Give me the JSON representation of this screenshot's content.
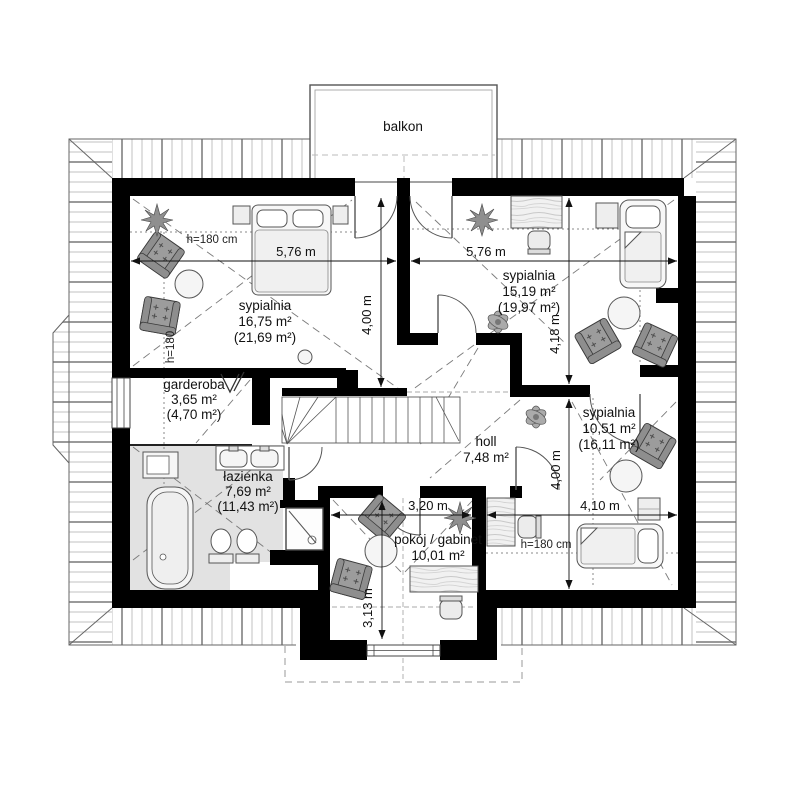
{
  "balcony": {
    "label": "balkon"
  },
  "rooms": {
    "sypialnia1": {
      "name": "sypialnia",
      "area": "16,75 m²",
      "area_roof": "(21,69 m²)"
    },
    "sypialnia2": {
      "name": "sypialnia",
      "area": "15,19 m²",
      "area_roof": "(19,97 m²)"
    },
    "garderoba": {
      "name": "garderoba",
      "area": "3,65 m²",
      "area_roof": "(4,70 m²)"
    },
    "lazienka": {
      "name": "łazienka",
      "area": "7,69 m²",
      "area_roof": "(11,43 m²)"
    },
    "holl": {
      "name": "holl",
      "area": "7,48 m²"
    },
    "pokoj_gabinet": {
      "name": "pokój / gabinet",
      "area": "10,01 m²"
    },
    "sypialnia3": {
      "name": "sypialnia",
      "area": "10,51 m²",
      "area_roof": "(16,11 m²)"
    }
  },
  "dimensions": {
    "bed1_width": "5,76 m",
    "bed2_width": "5,76 m",
    "bed1_depth": "4,00 m",
    "bed2_depth": "4,18 m",
    "bed3_depth": "4,00 m",
    "bed3_width": "4,10 m",
    "office_width": "3,20 m",
    "office_depth": "3,13 m"
  },
  "ceiling_heights": {
    "bed1": "h=180 cm",
    "bed1_side": "h=180",
    "bed3": "h=180 cm"
  }
}
